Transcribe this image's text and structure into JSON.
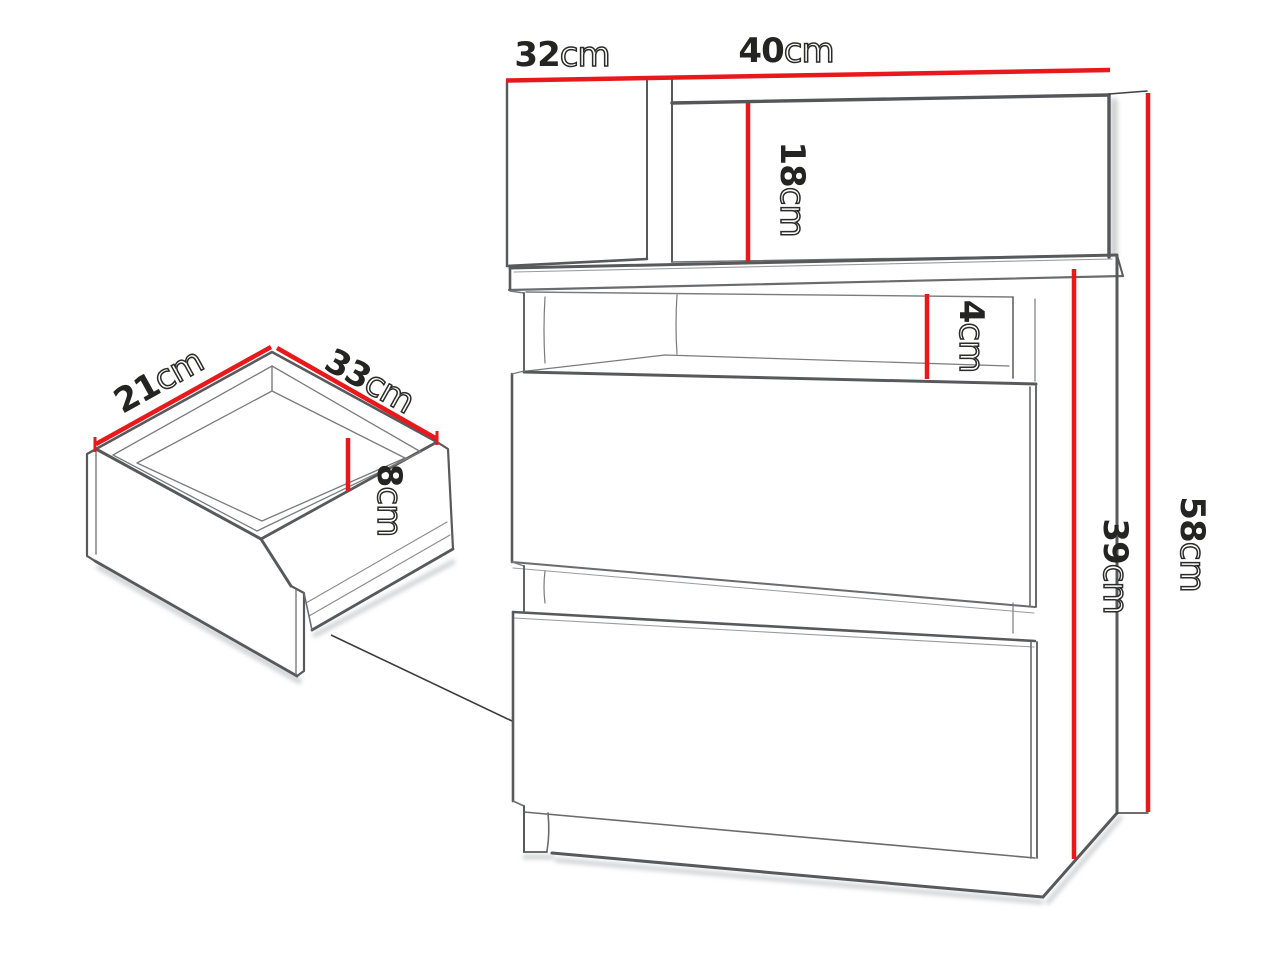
{
  "figure": {
    "type": "furniture-dimension-diagram",
    "subject": "nightstand with open shelf and two drawers, with exploded drawer-box detail",
    "accent_color": "#e8191c",
    "line_color": "#58595b",
    "text_color": "#242422"
  },
  "dimensions": {
    "cabinet": [
      {
        "id": "top-side-depth",
        "value": "32",
        "unit": "cm"
      },
      {
        "id": "top-back-width",
        "value": "40",
        "unit": "cm"
      },
      {
        "id": "back-panel-height",
        "value": "18",
        "unit": "cm"
      },
      {
        "id": "shelf-opening-height",
        "value": "4",
        "unit": "cm"
      },
      {
        "id": "drawer-section-height",
        "value": "39",
        "unit": "cm"
      },
      {
        "id": "total-height",
        "value": "58",
        "unit": "cm"
      }
    ],
    "drawer_detail": [
      {
        "id": "drawer-depth",
        "value": "21",
        "unit": "cm"
      },
      {
        "id": "drawer-width",
        "value": "33",
        "unit": "cm"
      },
      {
        "id": "drawer-inner-height",
        "value": "8",
        "unit": "cm"
      }
    ]
  }
}
